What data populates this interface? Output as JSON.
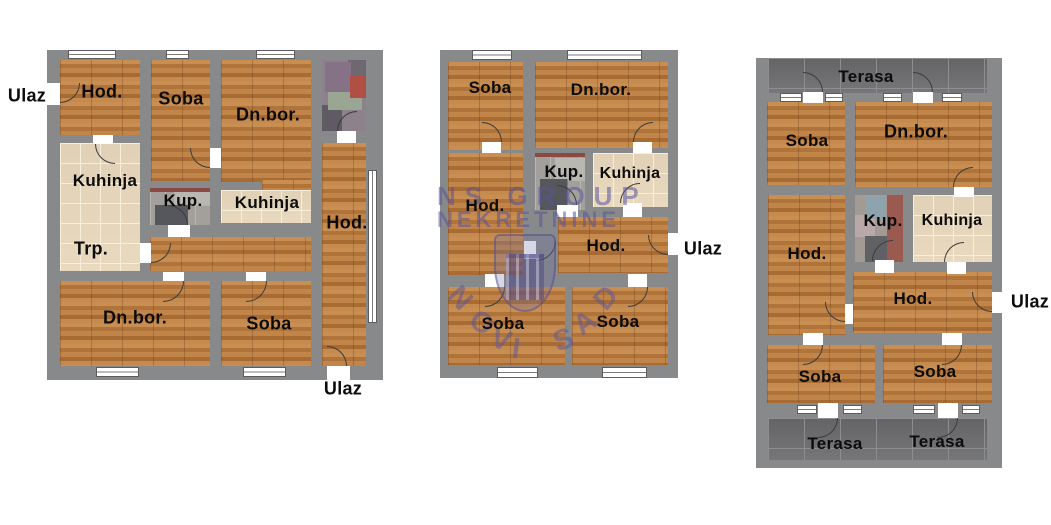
{
  "watermark": {
    "line1": "NS GROUP",
    "line2": "NEKRETNINE",
    "arc_text": "NOVI SAD",
    "color": "#58539e"
  },
  "colors": {
    "wall": "#87898a",
    "wood_floor": "#bd8045",
    "kitchen_tile": "#e8d9bf",
    "bath_tile": "#a3a09c",
    "terrace_tile": "#6f6f71",
    "label_text": "#0c0c0c",
    "background": "#ffffff"
  },
  "plans": [
    {
      "id": "plan-left",
      "wall": {
        "x": 47,
        "y": 50,
        "w": 336,
        "h": 330
      },
      "rooms": [
        {
          "floor": "wood",
          "x": 60,
          "y": 60,
          "w": 80,
          "h": 75
        },
        {
          "floor": "wood",
          "x": 151,
          "y": 60,
          "w": 59,
          "h": 121
        },
        {
          "floor": "wood",
          "x": 221,
          "y": 60,
          "w": 90,
          "h": 122
        },
        {
          "floor": "wood",
          "x": 262,
          "y": 180,
          "w": 49,
          "h": 10
        },
        {
          "floor": "mosaic-a",
          "x": 322,
          "y": 60,
          "w": 44,
          "h": 71
        },
        {
          "floor": "beige",
          "x": 60,
          "y": 143,
          "w": 80,
          "h": 128
        },
        {
          "floor": "gray",
          "x": 150,
          "y": 188,
          "w": 60,
          "h": 37
        },
        {
          "floor": "beige",
          "x": 221,
          "y": 190,
          "w": 90,
          "h": 33
        },
        {
          "floor": "wood",
          "x": 150,
          "y": 237,
          "w": 161,
          "h": 34
        },
        {
          "floor": "wood",
          "x": 322,
          "y": 143,
          "w": 44,
          "h": 223
        },
        {
          "floor": "wood",
          "x": 60,
          "y": 281,
          "w": 150,
          "h": 85
        },
        {
          "floor": "wood",
          "x": 221,
          "y": 281,
          "w": 90,
          "h": 85
        }
      ],
      "windows": [
        {
          "x": 68,
          "y": 50,
          "w": 48,
          "h": 9,
          "dir": "h"
        },
        {
          "x": 166,
          "y": 50,
          "w": 23,
          "h": 9,
          "dir": "h"
        },
        {
          "x": 256,
          "y": 50,
          "w": 39,
          "h": 9,
          "dir": "h"
        },
        {
          "x": 96,
          "y": 367,
          "w": 43,
          "h": 10,
          "dir": "h"
        },
        {
          "x": 243,
          "y": 367,
          "w": 43,
          "h": 10,
          "dir": "h"
        },
        {
          "x": 368,
          "y": 170,
          "w": 9,
          "h": 153,
          "dir": "v"
        }
      ],
      "door_gaps": [
        {
          "x": 47,
          "y": 83,
          "w": 13,
          "h": 22
        },
        {
          "x": 93,
          "y": 135,
          "w": 20,
          "h": 9
        },
        {
          "x": 210,
          "y": 148,
          "w": 11,
          "h": 20
        },
        {
          "x": 337,
          "y": 131,
          "w": 19,
          "h": 12
        },
        {
          "x": 168,
          "y": 225,
          "w": 22,
          "h": 12
        },
        {
          "x": 140,
          "y": 243,
          "w": 11,
          "h": 20
        },
        {
          "x": 163,
          "y": 272,
          "w": 21,
          "h": 9
        },
        {
          "x": 246,
          "y": 272,
          "w": 20,
          "h": 9
        },
        {
          "x": 327,
          "y": 366,
          "w": 23,
          "h": 14
        }
      ],
      "door_arcs": [
        {
          "x": 60,
          "y": 83,
          "s": 20,
          "c": "br"
        },
        {
          "x": 95,
          "y": 144,
          "s": 20,
          "c": "bl"
        },
        {
          "x": 190,
          "y": 148,
          "s": 20,
          "c": "bl"
        },
        {
          "x": 337,
          "y": 111,
          "s": 20,
          "c": "tl"
        },
        {
          "x": 168,
          "y": 205,
          "s": 20,
          "c": "tr"
        },
        {
          "x": 151,
          "y": 243,
          "s": 20,
          "c": "br"
        },
        {
          "x": 163,
          "y": 281,
          "s": 21,
          "c": "br"
        },
        {
          "x": 246,
          "y": 281,
          "s": 21,
          "c": "br"
        },
        {
          "x": 327,
          "y": 346,
          "s": 20,
          "c": "tr"
        }
      ],
      "labels": [
        {
          "text": "Ulaz",
          "x": 27,
          "y": 96,
          "size": 18
        },
        {
          "text": "Hod.",
          "x": 102,
          "y": 92,
          "size": 18
        },
        {
          "text": "Soba",
          "x": 181,
          "y": 99,
          "size": 18
        },
        {
          "text": "Dn.bor.",
          "x": 268,
          "y": 115,
          "size": 18
        },
        {
          "text": "Kuhinja",
          "x": 105,
          "y": 181,
          "size": 17
        },
        {
          "text": "Kup.",
          "x": 183,
          "y": 201,
          "size": 17
        },
        {
          "text": "Kuhinja",
          "x": 267,
          "y": 203,
          "size": 17
        },
        {
          "text": "Hod.",
          "x": 347,
          "y": 223,
          "size": 18
        },
        {
          "text": "Trp.",
          "x": 91,
          "y": 249,
          "size": 18
        },
        {
          "text": "Dn.bor.",
          "x": 135,
          "y": 318,
          "size": 18
        },
        {
          "text": "Soba",
          "x": 269,
          "y": 324,
          "size": 18
        },
        {
          "text": "Ulaz",
          "x": 343,
          "y": 389,
          "size": 18
        }
      ]
    },
    {
      "id": "plan-middle",
      "wall": {
        "x": 440,
        "y": 50,
        "w": 238,
        "h": 328
      },
      "rooms": [
        {
          "floor": "wood",
          "x": 448,
          "y": 62,
          "w": 75,
          "h": 88
        },
        {
          "floor": "wood",
          "x": 535,
          "y": 62,
          "w": 133,
          "h": 86
        },
        {
          "floor": "gray",
          "x": 535,
          "y": 153,
          "w": 50,
          "h": 57
        },
        {
          "floor": "beige",
          "x": 593,
          "y": 153,
          "w": 75,
          "h": 54
        },
        {
          "floor": "wood",
          "x": 448,
          "y": 153,
          "w": 75,
          "h": 122
        },
        {
          "floor": "wood",
          "x": 558,
          "y": 217,
          "w": 110,
          "h": 56
        },
        {
          "floor": "wood",
          "x": 448,
          "y": 287,
          "w": 117,
          "h": 78
        },
        {
          "floor": "wood",
          "x": 572,
          "y": 287,
          "w": 96,
          "h": 78
        }
      ],
      "windows": [
        {
          "x": 472,
          "y": 50,
          "w": 40,
          "h": 10,
          "dir": "h"
        },
        {
          "x": 567,
          "y": 50,
          "w": 75,
          "h": 10,
          "dir": "h"
        },
        {
          "x": 497,
          "y": 367,
          "w": 41,
          "h": 11,
          "dir": "h"
        },
        {
          "x": 602,
          "y": 367,
          "w": 45,
          "h": 11,
          "dir": "h"
        }
      ],
      "door_gaps": [
        {
          "x": 482,
          "y": 142,
          "w": 19,
          "h": 11
        },
        {
          "x": 633,
          "y": 142,
          "w": 19,
          "h": 11
        },
        {
          "x": 557,
          "y": 205,
          "w": 21,
          "h": 12
        },
        {
          "x": 623,
          "y": 203,
          "w": 19,
          "h": 14
        },
        {
          "x": 524,
          "y": 241,
          "w": 12,
          "h": 18
        },
        {
          "x": 485,
          "y": 274,
          "w": 19,
          "h": 13
        },
        {
          "x": 628,
          "y": 274,
          "w": 19,
          "h": 13
        },
        {
          "x": 668,
          "y": 233,
          "w": 10,
          "h": 22
        }
      ],
      "door_arcs": [
        {
          "x": 482,
          "y": 122,
          "s": 20,
          "c": "tr"
        },
        {
          "x": 633,
          "y": 122,
          "s": 20,
          "c": "tl"
        },
        {
          "x": 557,
          "y": 185,
          "s": 20,
          "c": "tr"
        },
        {
          "x": 620,
          "y": 183,
          "s": 20,
          "c": "tl"
        },
        {
          "x": 536,
          "y": 241,
          "s": 20,
          "c": "br"
        },
        {
          "x": 485,
          "y": 287,
          "s": 20,
          "c": "br"
        },
        {
          "x": 628,
          "y": 287,
          "s": 20,
          "c": "br"
        },
        {
          "x": 648,
          "y": 235,
          "s": 20,
          "c": "bl"
        }
      ],
      "labels": [
        {
          "text": "Soba",
          "x": 490,
          "y": 88,
          "size": 17
        },
        {
          "text": "Dn.bor.",
          "x": 601,
          "y": 90,
          "size": 17
        },
        {
          "text": "Kup.",
          "x": 564,
          "y": 172,
          "size": 17
        },
        {
          "text": "Kuhinja",
          "x": 630,
          "y": 174,
          "size": 16
        },
        {
          "text": "Hod.",
          "x": 485,
          "y": 206,
          "size": 17
        },
        {
          "text": "Hod.",
          "x": 606,
          "y": 246,
          "size": 17
        },
        {
          "text": "Soba",
          "x": 503,
          "y": 324,
          "size": 17
        },
        {
          "text": "Soba",
          "x": 618,
          "y": 322,
          "size": 17
        },
        {
          "text": "Ulaz",
          "x": 703,
          "y": 249,
          "size": 18
        }
      ]
    },
    {
      "id": "plan-right",
      "wall": {
        "x": 756,
        "y": 58,
        "w": 246,
        "h": 410
      },
      "rooms": [
        {
          "floor": "terrace",
          "x": 768,
          "y": 58,
          "w": 219,
          "h": 35
        },
        {
          "floor": "wood",
          "x": 767,
          "y": 102,
          "w": 78,
          "h": 83
        },
        {
          "floor": "wood",
          "x": 855,
          "y": 102,
          "w": 137,
          "h": 85
        },
        {
          "floor": "wood",
          "x": 768,
          "y": 195,
          "w": 77,
          "h": 140
        },
        {
          "floor": "mosaic-b",
          "x": 855,
          "y": 195,
          "w": 48,
          "h": 67
        },
        {
          "floor": "beige",
          "x": 913,
          "y": 195,
          "w": 79,
          "h": 67
        },
        {
          "floor": "wood",
          "x": 853,
          "y": 272,
          "w": 139,
          "h": 61
        },
        {
          "floor": "wood",
          "x": 767,
          "y": 345,
          "w": 108,
          "h": 58
        },
        {
          "floor": "wood",
          "x": 883,
          "y": 345,
          "w": 109,
          "h": 58
        },
        {
          "floor": "terrace",
          "x": 768,
          "y": 418,
          "w": 219,
          "h": 42
        }
      ],
      "windows": [
        {
          "x": 780,
          "y": 93,
          "w": 22,
          "h": 9,
          "dir": "h"
        },
        {
          "x": 825,
          "y": 93,
          "w": 18,
          "h": 9,
          "dir": "h"
        },
        {
          "x": 883,
          "y": 93,
          "w": 19,
          "h": 9,
          "dir": "h"
        },
        {
          "x": 942,
          "y": 93,
          "w": 20,
          "h": 9,
          "dir": "h"
        },
        {
          "x": 797,
          "y": 405,
          "w": 20,
          "h": 9,
          "dir": "h"
        },
        {
          "x": 843,
          "y": 405,
          "w": 19,
          "h": 9,
          "dir": "h"
        },
        {
          "x": 913,
          "y": 405,
          "w": 22,
          "h": 9,
          "dir": "h"
        },
        {
          "x": 962,
          "y": 405,
          "w": 18,
          "h": 9,
          "dir": "h"
        }
      ],
      "door_gaps": [
        {
          "x": 803,
          "y": 92,
          "w": 20,
          "h": 11
        },
        {
          "x": 913,
          "y": 92,
          "w": 20,
          "h": 11
        },
        {
          "x": 954,
          "y": 187,
          "w": 20,
          "h": 10
        },
        {
          "x": 875,
          "y": 260,
          "w": 19,
          "h": 13
        },
        {
          "x": 947,
          "y": 262,
          "w": 19,
          "h": 12
        },
        {
          "x": 845,
          "y": 304,
          "w": 8,
          "h": 20
        },
        {
          "x": 803,
          "y": 333,
          "w": 20,
          "h": 12
        },
        {
          "x": 942,
          "y": 333,
          "w": 20,
          "h": 12
        },
        {
          "x": 992,
          "y": 292,
          "w": 10,
          "h": 21
        },
        {
          "x": 818,
          "y": 403,
          "w": 20,
          "h": 15
        },
        {
          "x": 938,
          "y": 403,
          "w": 20,
          "h": 15
        }
      ],
      "door_arcs": [
        {
          "x": 803,
          "y": 72,
          "s": 20,
          "c": "tr"
        },
        {
          "x": 913,
          "y": 72,
          "s": 20,
          "c": "tr"
        },
        {
          "x": 953,
          "y": 167,
          "s": 20,
          "c": "tl"
        },
        {
          "x": 872,
          "y": 240,
          "s": 21,
          "c": "tl"
        },
        {
          "x": 944,
          "y": 242,
          "s": 20,
          "c": "tl"
        },
        {
          "x": 825,
          "y": 302,
          "s": 20,
          "c": "bl"
        },
        {
          "x": 803,
          "y": 345,
          "s": 20,
          "c": "br"
        },
        {
          "x": 942,
          "y": 345,
          "s": 20,
          "c": "br"
        },
        {
          "x": 972,
          "y": 292,
          "s": 20,
          "c": "bl"
        },
        {
          "x": 818,
          "y": 418,
          "s": 20,
          "c": "br"
        },
        {
          "x": 938,
          "y": 418,
          "s": 20,
          "c": "br"
        }
      ],
      "labels": [
        {
          "text": "Terasa",
          "x": 866,
          "y": 77,
          "size": 17
        },
        {
          "text": "Soba",
          "x": 807,
          "y": 141,
          "size": 17
        },
        {
          "text": "Dn.bor.",
          "x": 916,
          "y": 132,
          "size": 18
        },
        {
          "text": "Hod.",
          "x": 807,
          "y": 254,
          "size": 17
        },
        {
          "text": "Kup.",
          "x": 883,
          "y": 221,
          "size": 17
        },
        {
          "text": "Kuhinja",
          "x": 952,
          "y": 221,
          "size": 16
        },
        {
          "text": "Hod.",
          "x": 913,
          "y": 299,
          "size": 17
        },
        {
          "text": "Ulaz",
          "x": 1030,
          "y": 302,
          "size": 18
        },
        {
          "text": "Soba",
          "x": 820,
          "y": 377,
          "size": 17
        },
        {
          "text": "Soba",
          "x": 935,
          "y": 372,
          "size": 17
        },
        {
          "text": "Terasa",
          "x": 835,
          "y": 444,
          "size": 17
        },
        {
          "text": "Terasa",
          "x": 937,
          "y": 442,
          "size": 17
        }
      ]
    }
  ]
}
